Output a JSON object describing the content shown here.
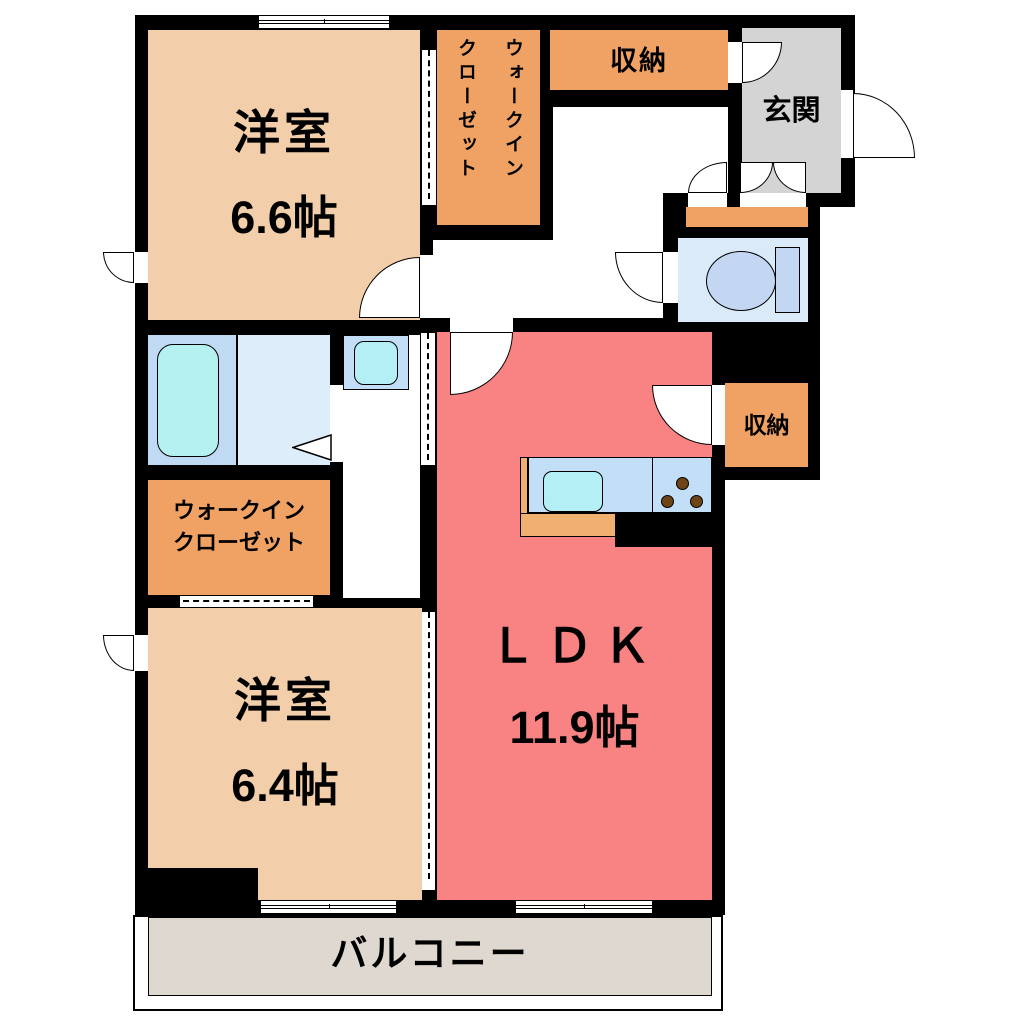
{
  "floorplan": {
    "rooms": {
      "bedroom1": {
        "name": "洋室",
        "size": "6.6帖"
      },
      "bedroom2": {
        "name": "洋室",
        "size": "6.4帖"
      },
      "ldk": {
        "name": "ＬＤＫ",
        "size": "11.9帖"
      },
      "wic_top": {
        "line1": "ウォークイン",
        "line2": "クローゼット"
      },
      "wic_bottom": {
        "line1": "ウォークイン",
        "line2": "クローゼット"
      },
      "storage_top": {
        "name": "収納"
      },
      "storage_right": {
        "name": "収納"
      },
      "entrance": {
        "name": "玄関"
      },
      "balcony": {
        "name": "バルコニー"
      }
    },
    "colors": {
      "wall": "#000000",
      "bedroom": "#F2CFAA",
      "closet": "#EFA263",
      "ldk": "#F98383",
      "entrance": "#D4D4D4",
      "toilet-room": "#DAEAF9",
      "bath-left": "#C0DAF3",
      "bath-right": "#DEEDFA",
      "tub": "#B6F1F1",
      "fixture-blue": "#C3D7F2",
      "counter": "#C3DEF7",
      "sink": "#B3EFF5",
      "burner": "#6F4518",
      "balcony": "#DFD8D0",
      "kitchen-edge": "#F0B070"
    }
  }
}
